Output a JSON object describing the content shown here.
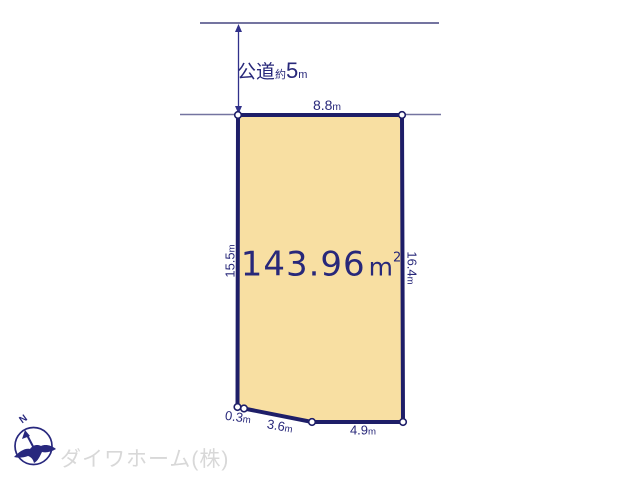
{
  "road": {
    "name": "公道",
    "approx_prefix": "約",
    "width_value": "5",
    "width_unit": "m"
  },
  "plot": {
    "area": {
      "value": "143.96",
      "unit": "m",
      "superscript": "2"
    },
    "fill_color": "#f8dfa2",
    "outline_color": "#1e1e68",
    "dimensions": {
      "top": {
        "value": "8.8",
        "unit": "m"
      },
      "left": {
        "value": "15.5",
        "unit": "m"
      },
      "right": {
        "value": "16.4",
        "unit": "m"
      },
      "bottom_left": {
        "value": "0.3",
        "unit": "m"
      },
      "bottom_slant": {
        "value": "3.6",
        "unit": "m"
      },
      "bottom_right": {
        "value": "4.9",
        "unit": "m"
      }
    }
  },
  "compass": {
    "north_label": "N"
  },
  "footer": {
    "company_name": "ダイワホーム(株)"
  },
  "colors": {
    "dimension_text": "#28287a",
    "road_line": "#7474a0",
    "arrow": "#31318a",
    "logo_text": "#d8d8d8"
  }
}
